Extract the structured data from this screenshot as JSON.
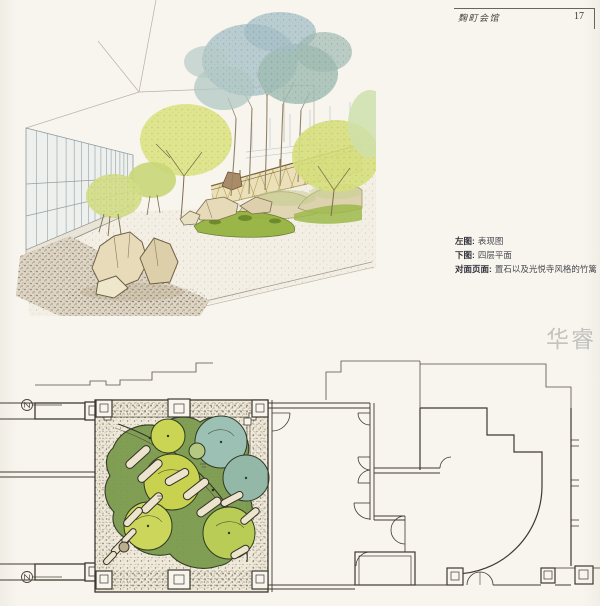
{
  "page": {
    "running_title": "麹町会馆",
    "page_number": "17",
    "watermark": "华睿"
  },
  "captions": {
    "lines": [
      {
        "label": "左图:",
        "text": "表现图"
      },
      {
        "label": "下图:",
        "text": "四层平面"
      },
      {
        "label": "对面页面:",
        "text": "置石以及光悦寺风格的竹篱"
      }
    ]
  },
  "palette": {
    "paper": "#f8f5ee",
    "ink": "#3f3a30",
    "leaf_yellow_green": "#ccd44e",
    "leaf_blue_green": "#9fc0ae",
    "moss_green": "#7c9a4e",
    "rock_beige": "#e8dcbc",
    "fence_tan": "#e9dcae",
    "watermark_gray": "#9e9e9e"
  }
}
